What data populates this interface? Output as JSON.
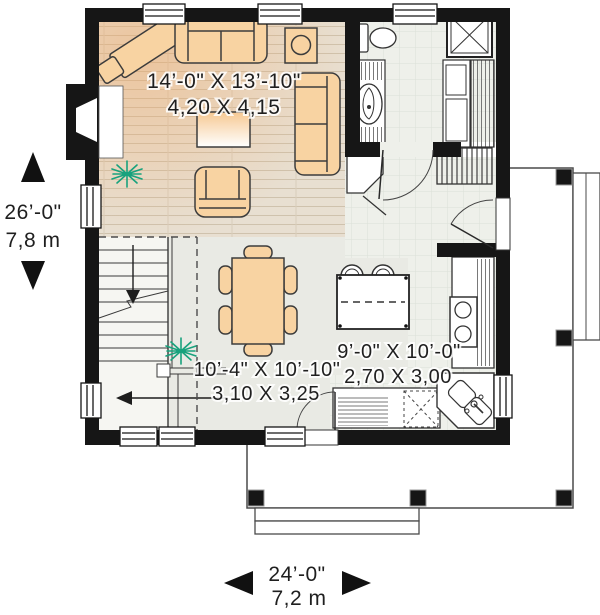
{
  "plan_type": "floor-plan",
  "rooms": {
    "living": {
      "imperial": "14’-0\" X 13’-10\"",
      "metric": "4,20 X 4,15"
    },
    "dining": {
      "imperial": "10’-4\" X 10’-10\"",
      "metric": "3,10 X 3,25"
    },
    "kitchen": {
      "imperial": "9’-0\" X 10’-0\"",
      "metric": "2,70 X 3,00"
    }
  },
  "dimensions": {
    "depth": {
      "imperial": "26’-0\"",
      "metric": "7,8 m"
    },
    "width": {
      "imperial": "24’-0\"",
      "metric": "7,2 m"
    }
  },
  "colors": {
    "wall": "#161616",
    "furniture_fill": "#f8d3a2",
    "furniture_outline": "#3c3c3c",
    "wood_floor": "#e8dfd1",
    "tile_floor": "#eef0ea",
    "dining_floor": "#e9eae4",
    "plant": "#18a27d",
    "porch_outline": "#4a4a4a"
  },
  "icons": [
    "fireplace-icon",
    "chimney-icon",
    "sofa-icon",
    "console-table-icon",
    "accent-chair-icon",
    "lamp-table-icon",
    "loveseat-icon",
    "coffee-table-icon",
    "armchair-icon",
    "plant-icon",
    "stairs-icon",
    "stair-arrow-icon",
    "dining-table-icon",
    "dining-chair-icon",
    "island-icon",
    "stool-icon",
    "counter-icon",
    "stove-icon",
    "dishwasher-icon",
    "kitchen-sink-icon",
    "toilet-icon",
    "vanity-sink-icon",
    "shower-icon",
    "bath-cabinet-icon",
    "linen-shelves-icon",
    "coat-closet-icon",
    "corner-closet-icon",
    "door-swing-icon",
    "window-icon",
    "porch-post-icon",
    "porch-steps-icon",
    "dimension-arrow-icon"
  ]
}
